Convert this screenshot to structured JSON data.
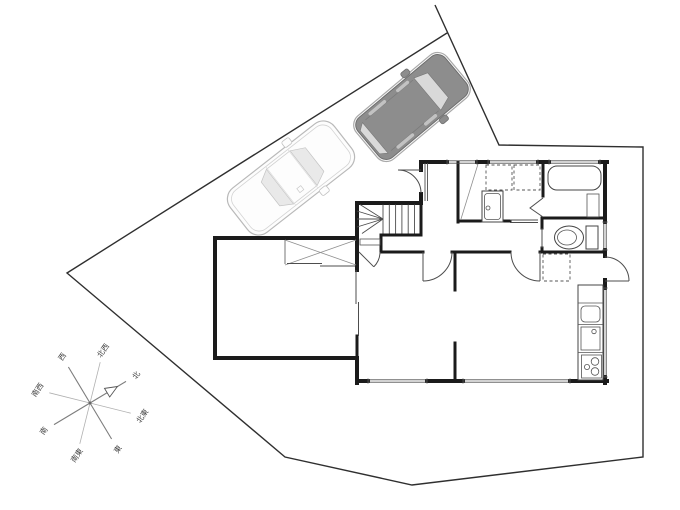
{
  "title": "site-and-floor-plan-drawing",
  "canvas": {
    "width": 680,
    "height": 510,
    "background": "#ffffff"
  },
  "colors": {
    "site_boundary": "#2f2f2f",
    "wall": "#1b1b1b",
    "fixture_line": "#4d4d4d",
    "gray_car_body": "#8d8d8d",
    "gray_car_trim": "#6e6e6e",
    "gray_car_glass": "#d9d9d9",
    "white_car_body": "#fdfdfd",
    "white_car_outline": "#b9b9b9",
    "white_car_glass": "#e9e9e9",
    "compass_ray": "#7d7d7d",
    "compass_text": "#3f3f3f"
  },
  "compass": {
    "directions": [
      {
        "id": "north",
        "label": "北"
      },
      {
        "id": "northeast",
        "label": "北東"
      },
      {
        "id": "east",
        "label": "東"
      },
      {
        "id": "southeast",
        "label": "南東"
      },
      {
        "id": "south",
        "label": "南"
      },
      {
        "id": "southwest",
        "label": "南西"
      },
      {
        "id": "west",
        "label": "西"
      },
      {
        "id": "northwest",
        "label": "北西"
      }
    ],
    "north_arrow": "open-triangle"
  },
  "vehicles": [
    {
      "id": "suv",
      "body": "gray",
      "heading": "northeast"
    },
    {
      "id": "sedan",
      "body": "white",
      "heading": "northeast"
    }
  ],
  "plan_symbols": [
    "staircase-with-winders",
    "entrance-door-swing",
    "entrance-step",
    "closet-with-x",
    "closet-sliding-doors",
    "tatami-room-sliding-door",
    "washing-machine-space-dashed",
    "vanity-sink",
    "bathtub",
    "bathroom-folding-door",
    "toilet",
    "refrigerator-space-dashed",
    "kitchen-counter-with-sink-and-stove",
    "kitchen-back-door-swing",
    "interior-door-swings",
    "windows"
  ]
}
